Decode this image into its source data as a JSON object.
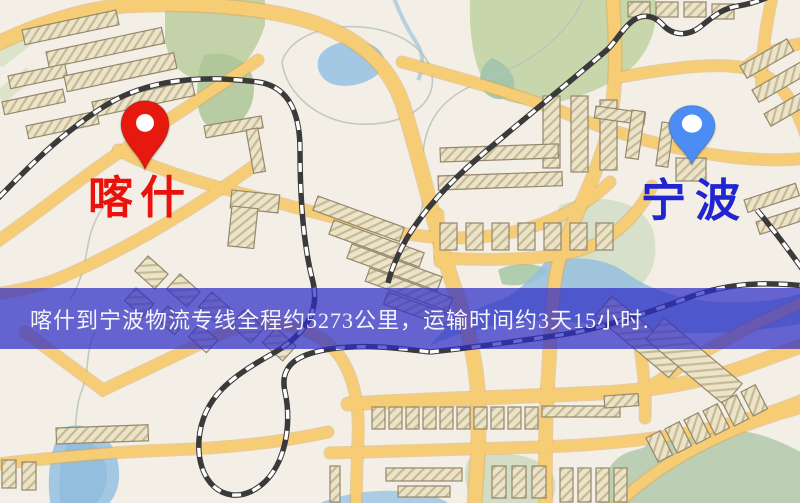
{
  "banner": {
    "text": "喀什到宁波物流专线全程约5273公里，运输时间约3天15小时."
  },
  "markers": {
    "origin": {
      "name": "喀什",
      "pin_color": "#e7180d",
      "label_color": "#ea120c"
    },
    "destination": {
      "name": "宁波",
      "pin_color": "#4b8cf5",
      "label_color": "#2125cf"
    }
  },
  "map_colors": {
    "background": "#f4efe6",
    "road": "#f6cd74",
    "road_casing": "#e0a94e",
    "building": "#ece4c9",
    "building_outline": "#94876c",
    "water": "#a2c8e4",
    "park": "#c8d7ab",
    "railway": "#3a3a3a",
    "banner_bg": "rgba(46,44,198,0.72)",
    "banner_text": "#f4f4fa"
  }
}
